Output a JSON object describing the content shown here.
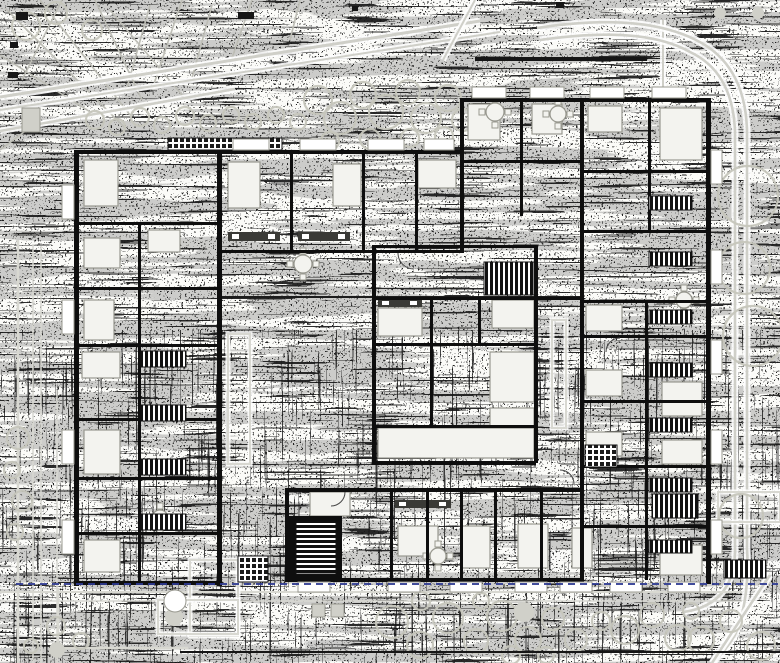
{
  "meta": {
    "type": "architectural-floor-plan",
    "width": 780,
    "height": 663,
    "description": "Dithered scanned floor plan of a multi-unit residential building with landscaped site, stair cores, furniture symbols and blue site boundary line"
  },
  "palette": {
    "paper": "#fbfbf8",
    "ink": "#161616",
    "wall": "#0e0e0e",
    "furniture_fill": "#f3f3ef",
    "furniture_stroke": "#98988f",
    "road_gray": "#cfcfc8",
    "path_gray": "#d8d8d1",
    "tree_gray": "#c6c6bc",
    "branch_gray": "#bdbdb5",
    "boundary_blue": "#2e3a92",
    "dark_line": "#1c1c1c",
    "square_gray": "#d0d0c9"
  },
  "site": {
    "branches": [
      [
        5,
        8,
        125,
        128
      ],
      [
        40,
        0,
        130,
        115
      ],
      [
        95,
        0,
        142,
        100
      ],
      [
        0,
        55,
        95,
        115
      ],
      [
        150,
        5,
        125,
        95
      ],
      [
        182,
        0,
        152,
        90
      ],
      [
        62,
        0,
        22,
        80
      ],
      [
        110,
        10,
        182,
        95
      ],
      [
        212,
        5,
        192,
        78
      ],
      [
        252,
        0,
        232,
        58
      ],
      [
        0,
        150,
        40,
        120
      ],
      [
        300,
        0,
        290,
        40
      ]
    ],
    "road_lines": [
      [
        0,
        97,
        480,
        21,
        3
      ],
      [
        0,
        110,
        500,
        32,
        2
      ],
      [
        0,
        131,
        235,
        89,
        2.5
      ],
      [
        475,
        0,
        443,
        60,
        2
      ],
      [
        663,
        20,
        663,
        95,
        2
      ]
    ],
    "road_paths": [
      "M537,28 Q640,12 696,40 Q745,64 747,130 L747,548",
      "M540,40 Q642,25 690,52 Q733,72 735,132 L735,545",
      "M747,548 Q750,600 735,635 Q725,652 712,663",
      "M735,545 Q737,604 684,612",
      "M770,575 Q740,620 712,663"
    ],
    "gray_lines": [
      [
        0,
        592,
        742,
        592,
        2
      ],
      [
        0,
        601,
        742,
        601,
        1.5
      ],
      [
        18,
        240,
        18,
        663,
        2.5
      ],
      [
        33,
        244,
        33,
        663,
        1.5
      ],
      [
        41,
        246,
        41,
        663,
        1.5
      ],
      [
        57,
        390,
        57,
        663,
        1.5
      ]
    ],
    "path_outlines": [
      [
        228,
        334,
        22,
        130
      ],
      [
        190,
        560,
        48,
        76
      ],
      [
        158,
        600,
        80,
        34
      ],
      [
        718,
        492,
        62,
        30
      ],
      [
        552,
        320,
        14,
        108
      ]
    ],
    "path_polylines": [
      "M58,588 L58,648 L188,648"
    ],
    "gray_squares": [
      [
        312,
        604,
        13,
        13
      ],
      [
        331,
        604,
        13,
        13
      ],
      [
        22,
        108,
        18,
        24
      ]
    ],
    "trees": [
      [
        95,
        120,
        9
      ],
      [
        117,
        127,
        8
      ],
      [
        140,
        117,
        9
      ],
      [
        162,
        125,
        8
      ],
      [
        185,
        116,
        9
      ],
      [
        208,
        123,
        8
      ],
      [
        231,
        115,
        8
      ],
      [
        253,
        122,
        8
      ],
      [
        276,
        115,
        8
      ],
      [
        298,
        122,
        8
      ],
      [
        318,
        100,
        14
      ],
      [
        340,
        118,
        16
      ],
      [
        363,
        95,
        13
      ],
      [
        386,
        112,
        17
      ],
      [
        408,
        92,
        12
      ],
      [
        426,
        118,
        15
      ],
      [
        448,
        98,
        13
      ],
      [
        463,
        120,
        11
      ],
      [
        330,
        141,
        9
      ],
      [
        370,
        139,
        10
      ],
      [
        410,
        138,
        9
      ],
      [
        444,
        136,
        9
      ],
      [
        26,
        26,
        14
      ],
      [
        56,
        13,
        11
      ],
      [
        92,
        30,
        10
      ],
      [
        748,
        196,
        30
      ],
      [
        744,
        268,
        26
      ],
      [
        753,
        336,
        30
      ],
      [
        741,
        516,
        22
      ],
      [
        392,
        622,
        16
      ],
      [
        420,
        645,
        13
      ],
      [
        448,
        618,
        15
      ],
      [
        476,
        641,
        12
      ],
      [
        502,
        616,
        15
      ],
      [
        528,
        640,
        13
      ],
      [
        553,
        619,
        11
      ],
      [
        421,
        601,
        9
      ],
      [
        481,
        601,
        8
      ],
      [
        511,
        655,
        9
      ],
      [
        546,
        655,
        8
      ],
      [
        576,
        640,
        11
      ],
      [
        601,
        621,
        9
      ],
      [
        625,
        630,
        14
      ],
      [
        652,
        615,
        12
      ],
      [
        678,
        638,
        13
      ],
      [
        701,
        640,
        13
      ],
      [
        731,
        621,
        11
      ],
      [
        761,
        646,
        14
      ],
      [
        691,
        611,
        8
      ],
      [
        18,
        438,
        11
      ],
      [
        12,
        470,
        8
      ],
      [
        22,
        501,
        10
      ],
      [
        15,
        532,
        8
      ],
      [
        56,
        626,
        9
      ],
      [
        81,
        641,
        8
      ],
      [
        31,
        646,
        7
      ]
    ],
    "gray_dots": [
      [
        174,
        617,
        9
      ],
      [
        57,
        650,
        8
      ],
      [
        720,
        13,
        6
      ],
      [
        758,
        13,
        6
      ],
      [
        524,
        612,
        10
      ]
    ],
    "white_circles": [
      [
        175,
        601,
        11
      ]
    ]
  },
  "building": {
    "walls": [
      [
        74,
        150,
        5,
        436
      ],
      [
        217,
        150,
        5,
        436
      ],
      [
        74,
        150,
        148,
        4
      ],
      [
        74,
        581,
        148,
        4
      ],
      [
        74,
        222,
        148,
        3
      ],
      [
        74,
        287,
        148,
        3
      ],
      [
        74,
        344,
        148,
        3
      ],
      [
        74,
        418,
        148,
        3
      ],
      [
        74,
        477,
        148,
        3
      ],
      [
        74,
        532,
        148,
        3
      ],
      [
        138,
        222,
        3,
        359
      ],
      [
        222,
        150,
        240,
        4
      ],
      [
        222,
        250,
        240,
        3
      ],
      [
        290,
        150,
        3,
        100
      ],
      [
        362,
        150,
        3,
        100
      ],
      [
        415,
        150,
        3,
        100
      ],
      [
        460,
        98,
        250,
        4
      ],
      [
        460,
        98,
        4,
        155
      ],
      [
        460,
        297,
        124,
        3
      ],
      [
        520,
        98,
        3,
        118
      ],
      [
        580,
        98,
        4,
        484
      ],
      [
        648,
        98,
        3,
        132
      ],
      [
        460,
        160,
        122,
        3
      ],
      [
        584,
        170,
        122,
        3
      ],
      [
        584,
        230,
        122,
        3
      ],
      [
        706,
        98,
        5,
        486
      ],
      [
        583,
        300,
        123,
        3
      ],
      [
        583,
        335,
        123,
        3
      ],
      [
        583,
        400,
        123,
        3
      ],
      [
        583,
        465,
        123,
        3
      ],
      [
        583,
        525,
        123,
        3
      ],
      [
        645,
        300,
        3,
        280
      ],
      [
        372,
        245,
        4,
        218
      ],
      [
        534,
        245,
        4,
        218
      ],
      [
        372,
        245,
        164,
        3
      ],
      [
        372,
        461,
        164,
        4
      ],
      [
        372,
        297,
        164,
        3
      ],
      [
        372,
        343,
        164,
        3
      ],
      [
        372,
        425,
        164,
        3
      ],
      [
        430,
        297,
        3,
        128
      ],
      [
        478,
        297,
        3,
        46
      ],
      [
        285,
        488,
        298,
        4
      ],
      [
        285,
        578,
        298,
        4
      ],
      [
        285,
        488,
        4,
        92
      ],
      [
        390,
        490,
        3,
        90
      ],
      [
        426,
        490,
        3,
        90
      ],
      [
        460,
        490,
        3,
        90
      ],
      [
        494,
        490,
        3,
        90
      ],
      [
        540,
        490,
        3,
        90
      ]
    ],
    "thin_lines": [
      [
        222,
        297,
        580,
        297,
        2
      ]
    ],
    "solid_blocks": [
      [
        288,
        516,
        54,
        64
      ]
    ],
    "stairs_v": [
      [
        141,
        351,
        45,
        16
      ],
      [
        141,
        405,
        45,
        16
      ],
      [
        141,
        459,
        45,
        16
      ],
      [
        141,
        514,
        45,
        16
      ],
      [
        484,
        262,
        50,
        33
      ],
      [
        649,
        196,
        43,
        14
      ],
      [
        649,
        252,
        43,
        14
      ],
      [
        649,
        310,
        43,
        14
      ],
      [
        649,
        363,
        43,
        14
      ],
      [
        649,
        418,
        43,
        14
      ],
      [
        649,
        478,
        43,
        14
      ],
      [
        652,
        494,
        46,
        24
      ],
      [
        649,
        540,
        43,
        13
      ],
      [
        724,
        560,
        42,
        18
      ]
    ],
    "stairs_h": [
      [
        296,
        522,
        40,
        52
      ]
    ],
    "stairs_cross": [
      [
        238,
        556,
        30,
        26
      ],
      [
        168,
        138,
        114,
        12
      ],
      [
        585,
        445,
        32,
        22
      ]
    ],
    "kitchens": [
      [
        228,
        232,
        52,
        9
      ],
      [
        298,
        232,
        52,
        9
      ],
      [
        378,
        299,
        44,
        8
      ],
      [
        395,
        500,
        56,
        8
      ]
    ],
    "furniture": [
      [
        84,
        160,
        34,
        46
      ],
      [
        84,
        238,
        36,
        30
      ],
      [
        84,
        300,
        30,
        40
      ],
      [
        82,
        352,
        38,
        26
      ],
      [
        84,
        430,
        36,
        44
      ],
      [
        84,
        540,
        36,
        32
      ],
      [
        148,
        230,
        32,
        22
      ],
      [
        228,
        162,
        32,
        46
      ],
      [
        333,
        164,
        28,
        42
      ],
      [
        418,
        160,
        38,
        28
      ],
      [
        468,
        104,
        32,
        36
      ],
      [
        532,
        104,
        30,
        30
      ],
      [
        660,
        108,
        42,
        52
      ],
      [
        588,
        106,
        34,
        26
      ],
      [
        586,
        305,
        36,
        26
      ],
      [
        586,
        370,
        36,
        26
      ],
      [
        586,
        432,
        36,
        24
      ],
      [
        662,
        382,
        40,
        34
      ],
      [
        662,
        440,
        40,
        24
      ],
      [
        660,
        545,
        42,
        30
      ],
      [
        572,
        528,
        20,
        40
      ],
      [
        492,
        300,
        42,
        28
      ],
      [
        490,
        352,
        44,
        50
      ],
      [
        490,
        408,
        44,
        42
      ],
      [
        378,
        308,
        44,
        28
      ],
      [
        378,
        428,
        156,
        30
      ],
      [
        398,
        526,
        40,
        30
      ],
      [
        462,
        526,
        28,
        42
      ],
      [
        518,
        524,
        30,
        44
      ],
      [
        310,
        492,
        40,
        24
      ]
    ],
    "tables": [
      [
        495,
        112,
        9
      ],
      [
        558,
        114,
        8
      ],
      [
        303,
        264,
        9
      ],
      [
        160,
        518,
        8
      ],
      [
        438,
        556,
        8
      ],
      [
        684,
        300,
        8
      ]
    ],
    "balconies": [
      [
        233,
        139,
        36,
        11
      ],
      [
        300,
        139,
        36,
        11
      ],
      [
        368,
        139,
        36,
        11
      ],
      [
        424,
        139,
        30,
        11
      ],
      [
        472,
        87,
        34,
        11
      ],
      [
        530,
        87,
        34,
        11
      ],
      [
        590,
        87,
        34,
        11
      ],
      [
        652,
        87,
        34,
        11
      ],
      [
        711,
        150,
        11,
        34
      ],
      [
        711,
        250,
        11,
        34
      ],
      [
        711,
        340,
        11,
        34
      ],
      [
        711,
        430,
        11,
        34
      ],
      [
        711,
        520,
        11,
        34
      ],
      [
        62,
        185,
        12,
        34
      ],
      [
        62,
        300,
        12,
        34
      ],
      [
        62,
        430,
        12,
        34
      ],
      [
        62,
        520,
        12,
        34
      ],
      [
        298,
        582,
        32,
        10
      ],
      [
        388,
        582,
        32,
        10
      ],
      [
        450,
        582,
        32,
        10
      ],
      [
        515,
        582,
        32,
        10
      ],
      [
        560,
        582,
        32,
        10
      ],
      [
        610,
        582,
        32,
        10
      ],
      [
        668,
        582,
        32,
        10
      ]
    ],
    "doors": [
      "M398,253 a16,16 0 0 0 16,16",
      "M560,470 a14,14 0 0 1 14,14",
      "M620,338 a14,14 0 0 0 -14,14",
      "M345,492 a14,14 0 0 1 -14,14"
    ]
  },
  "marks": {
    "black": [
      [
        556,
        2,
        8,
        6
      ],
      [
        238,
        12,
        16,
        7
      ],
      [
        16,
        12,
        12,
        8
      ],
      [
        10,
        42,
        8,
        6
      ],
      [
        8,
        72,
        10,
        6
      ],
      [
        352,
        6,
        6,
        5
      ],
      [
        475,
        57,
        172,
        4
      ],
      [
        180,
        651,
        600,
        2
      ]
    ],
    "blue_dashed": {
      "x1": 16,
      "y1": 584,
      "x2": 778,
      "y2": 584,
      "width": 2,
      "dash": "7 5"
    }
  }
}
